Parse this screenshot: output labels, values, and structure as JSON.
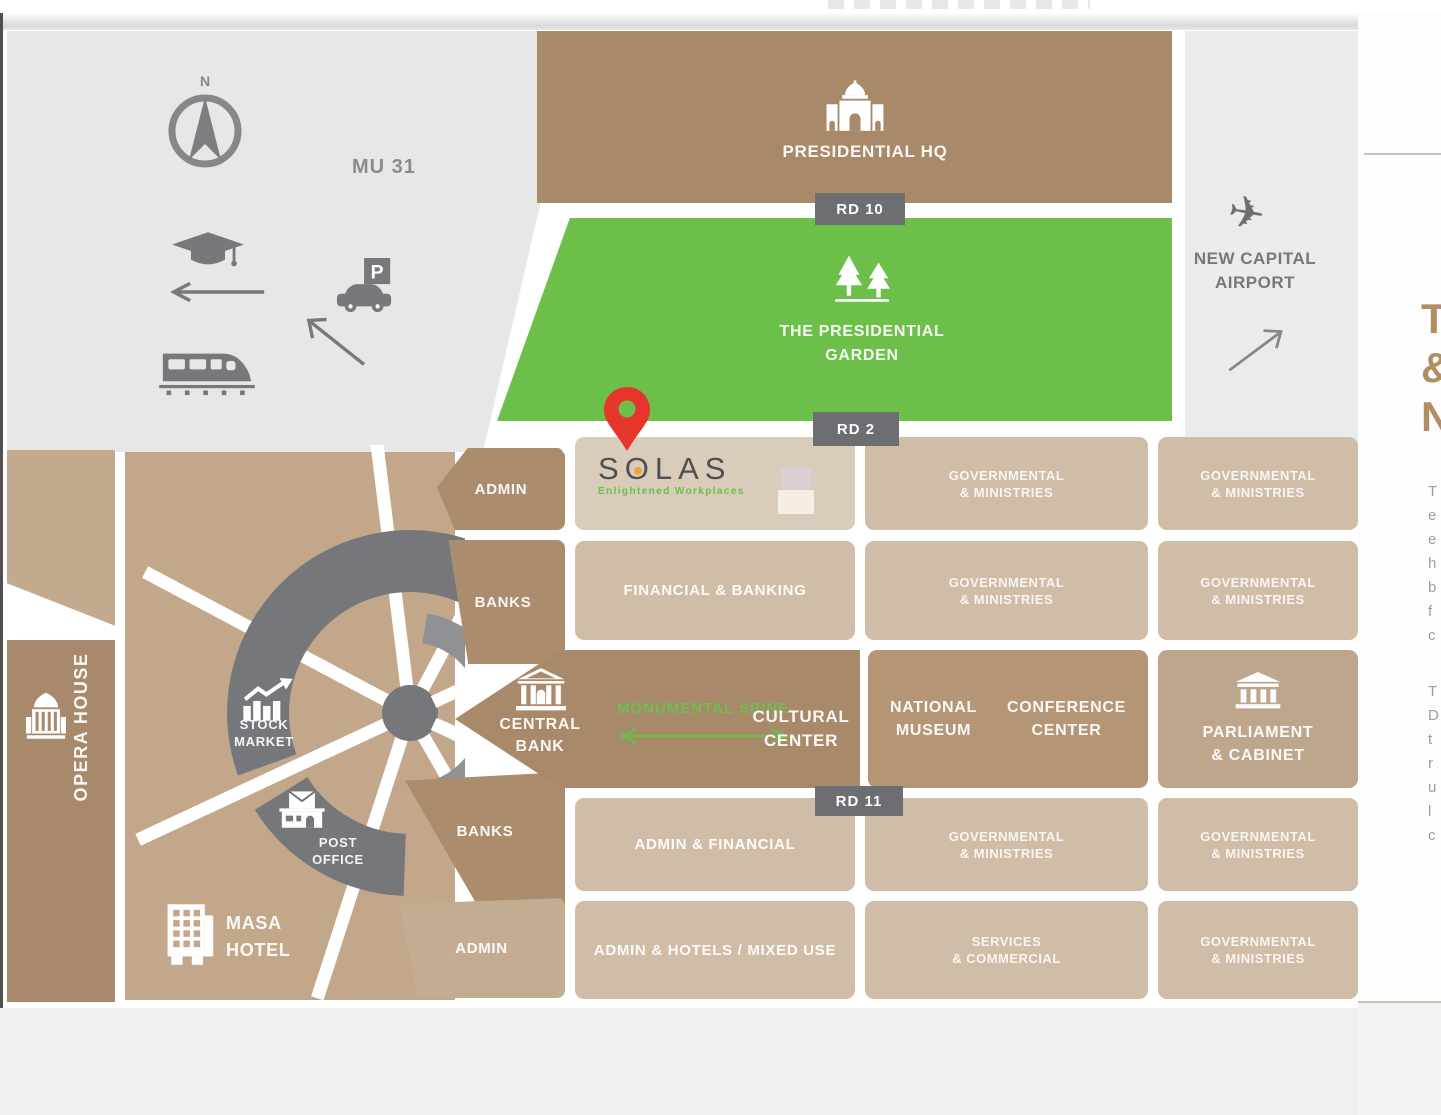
{
  "colors": {
    "garden_green": "#6cc04a",
    "brown_dark": "#a8896a",
    "tan_light": "#cfbda8",
    "panel_gray": "#e7e7e8",
    "badge_gray": "#6d6e71",
    "ring_gray": "#76777b",
    "pin_red": "#e6352b",
    "solas_dot_orange": "#f2a33c",
    "spine_green": "#6fbf4f",
    "sidebar_heading_tan": "#b08d62"
  },
  "map": {
    "zone_label": "MU 31",
    "compass_north": "N",
    "road_badges": {
      "rd10": "RD 10",
      "rd2": "RD 2",
      "rd11": "RD 11"
    },
    "landmarks": {
      "presidential_hq": "PRESIDENTIAL HQ",
      "garden_line1": "THE PRESIDENTIAL",
      "garden_line2": "GARDEN",
      "airport_line1": "NEW CAPITAL",
      "airport_line2": "AIRPORT",
      "opera_house": "OPERA HOUSE",
      "stock_market_line1": "STOCK",
      "stock_market_line2": "MARKET",
      "post_office_line1": "POST",
      "post_office_line2": "OFFICE",
      "masa_hotel_line1": "MASA",
      "masa_hotel_line2": "HOTEL",
      "central_bank_line1": "CENTRAL",
      "central_bank_line2": "BANK",
      "monumental_spine": "MONUMENTAL SPINE",
      "cultural_center_line1": "CULTURAL",
      "cultural_center_line2": "CENTER",
      "national_museum_line1": "NATIONAL",
      "national_museum_line2": "MUSEUM",
      "conference_center_line1": "CONFERENCE",
      "conference_center_line2": "CENTER",
      "parliament_line1": "PARLIAMENT",
      "parliament_line2": "& CABINET"
    },
    "blocks": {
      "admin": "ADMIN",
      "banks": "BANKS",
      "financial_banking": "FINANCIAL & BANKING",
      "admin_financial": "ADMIN & FINANCIAL",
      "admin_hotels_mixed": "ADMIN & HOTELS / MIXED USE",
      "services_line1": "SERVICES",
      "services_line2": "& COMMERCIAL",
      "gov_line1": "GOVERNMENTAL",
      "gov_line2": "& MINISTRIES"
    },
    "solas": {
      "brand_letters": [
        "S",
        "O",
        "L",
        "A",
        "S"
      ],
      "tagline": "Enlightened Workplaces"
    }
  },
  "sidebar": {
    "heading_fragments": [
      "T",
      "&",
      "N"
    ],
    "para1_fragments": [
      "T",
      "e",
      "e",
      "h",
      "b",
      "f",
      "c"
    ],
    "para2_fragments": [
      "T",
      "D",
      "t",
      "r",
      "u",
      "l",
      "c"
    ]
  }
}
